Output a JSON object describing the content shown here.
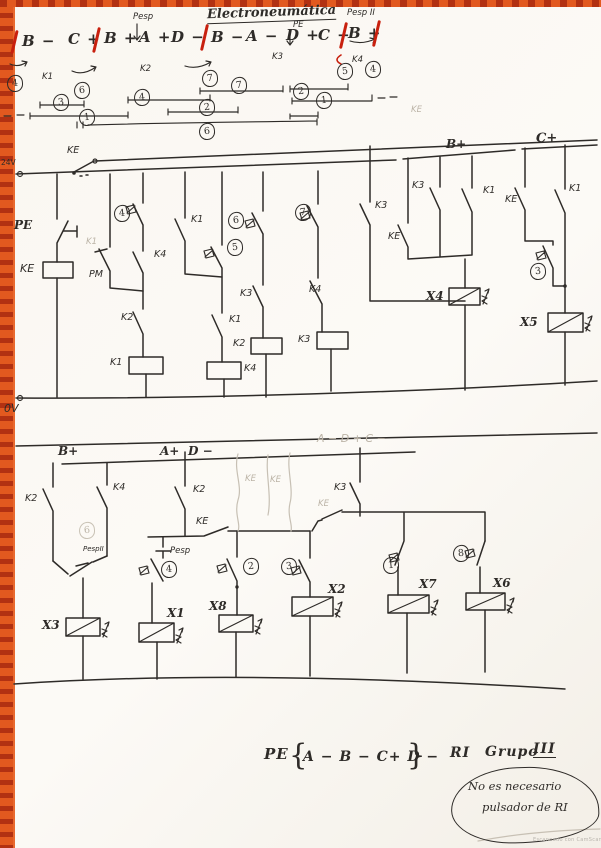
{
  "title": "Electroneumática",
  "sequence": {
    "tokens": [
      "B −",
      "C +",
      "B +",
      "A +",
      "D −",
      "B −",
      "A −",
      "D +",
      "C −",
      "B +"
    ],
    "pesp": "Pesp",
    "pe": "PE",
    "pesp2": "Pesp II",
    "k1": "K1",
    "k2": "K2",
    "k3": "K3",
    "k4": "K4",
    "circles": [
      "4",
      "6",
      "7",
      "5",
      "4"
    ],
    "bar_circles": [
      "7",
      "3",
      "1",
      "4",
      "2",
      "2",
      "1",
      "6"
    ],
    "ke_faint": "KE"
  },
  "upper": {
    "v24": "24V",
    "v0": "0V",
    "ke_switch": "KE",
    "bplus": "B+",
    "cplus": "C+",
    "pe": "PE",
    "ke_coil": "KE",
    "pm": "PM",
    "k1_faint": "K1",
    "k4_b3": "K4",
    "k1_b4": "K1",
    "k2_break": "K2",
    "coil_k1": "K1",
    "k1_b5": "K1",
    "coil_k4": "K4",
    "k3_b6": "K3",
    "coil_k2": "K2",
    "k4_b7": "K4",
    "coil_k3": "K3",
    "k3_b8": "K3",
    "k3_bp": "K3",
    "ke_bp": "KE",
    "k1_bp": "K1",
    "x4": "X4",
    "ke_cp": "KE",
    "k1_cp": "K1",
    "x5": "X5",
    "c3": "3",
    "c4": "4",
    "c5": "5",
    "c6": "6",
    "c7": "7"
  },
  "lower": {
    "bplus": "B+",
    "aplus": "A+",
    "dminus": "D −",
    "faint_seq": "A −  D +  C −",
    "k2_a": "K2",
    "k4_a": "K4",
    "pesp2": "PespII",
    "c6_faint": "6",
    "k2_b": "K2",
    "ke_a": "KE",
    "pesp": "Pesp",
    "ke_f1": "KE",
    "ke_f2": "KE",
    "k3": "K3",
    "ke_b": "KE",
    "c4": "4",
    "c2": "2",
    "c3": "3",
    "c1": "1",
    "c8": "8",
    "x3": "X3",
    "x1": "X1",
    "x8": "X8",
    "x2": "X2",
    "x7": "X7",
    "x6": "X6"
  },
  "footer": {
    "pe": "PE",
    "brace_l": "{",
    "brace_r": "}",
    "seq": "A −  B −  C+  D −",
    "ri": "RI",
    "grupo": "Grupo",
    "roman": "III",
    "note1": "No es necesario",
    "note2": "pulsador de RI",
    "watermark": "Escaneado con CamScanner"
  }
}
